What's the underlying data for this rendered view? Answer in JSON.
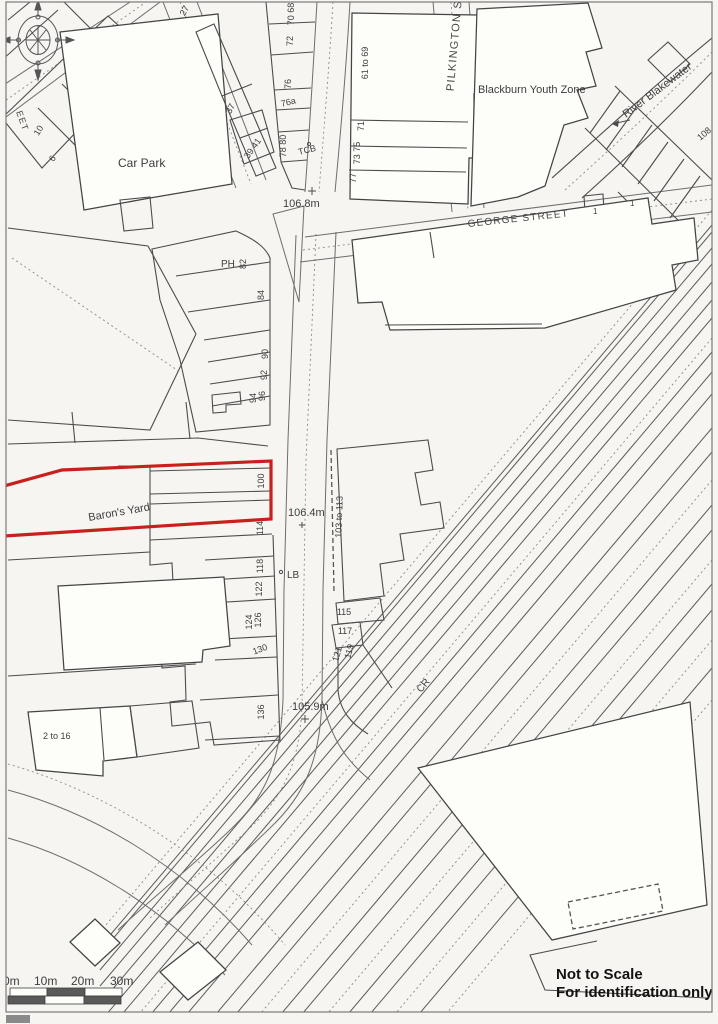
{
  "map": {
    "kind": "site-location-plan",
    "site": {
      "label": "Baron's Yard",
      "outline_color": "#c8201d"
    },
    "places": {
      "car_park": "Car Park",
      "youth_zone": "Blackburn Youth Zone",
      "river": "River Blakewater",
      "ph": "PH",
      "tcb": "TCB",
      "lb": "LB",
      "cr": "CR"
    },
    "streets": {
      "pilkington": "PILKINGTON ST",
      "george": "GEORGE STREET",
      "fragment": "EET"
    },
    "spot_heights": {
      "h1": "106.8m",
      "h2": "106.4m",
      "h3": "105.9m"
    },
    "numbers": {
      "n6": "6",
      "n10": "10",
      "n27": "27",
      "n37": "37",
      "n39_41": "39 41",
      "n70_68": "70 68",
      "n72": "72",
      "n76": "76",
      "n76a": "76a",
      "n78_80": "78 80",
      "n61_69": "61 to 69",
      "n71": "71",
      "n73_75": "73 75",
      "n77": "77",
      "n1a": "1",
      "n1b": "1",
      "n108": "108",
      "n82": "82",
      "n84": "84",
      "n90": "90",
      "n92": "92",
      "n94": "94",
      "n96": "96",
      "n100": "100",
      "n103_113": "103 to 113",
      "n114": "114",
      "n115": "115",
      "n117": "117",
      "n118": "118",
      "n119": "119",
      "n121": "121",
      "n122": "122",
      "n124": "124",
      "n126": "126",
      "n130": "130",
      "n136": "136",
      "n2_16": "2 to 16"
    },
    "scale_bar": {
      "t0": "0m",
      "t1": "10m",
      "t2": "20m",
      "t3": "30m"
    },
    "notes": {
      "line1": "Not to Scale",
      "line2": "For identification only"
    }
  }
}
